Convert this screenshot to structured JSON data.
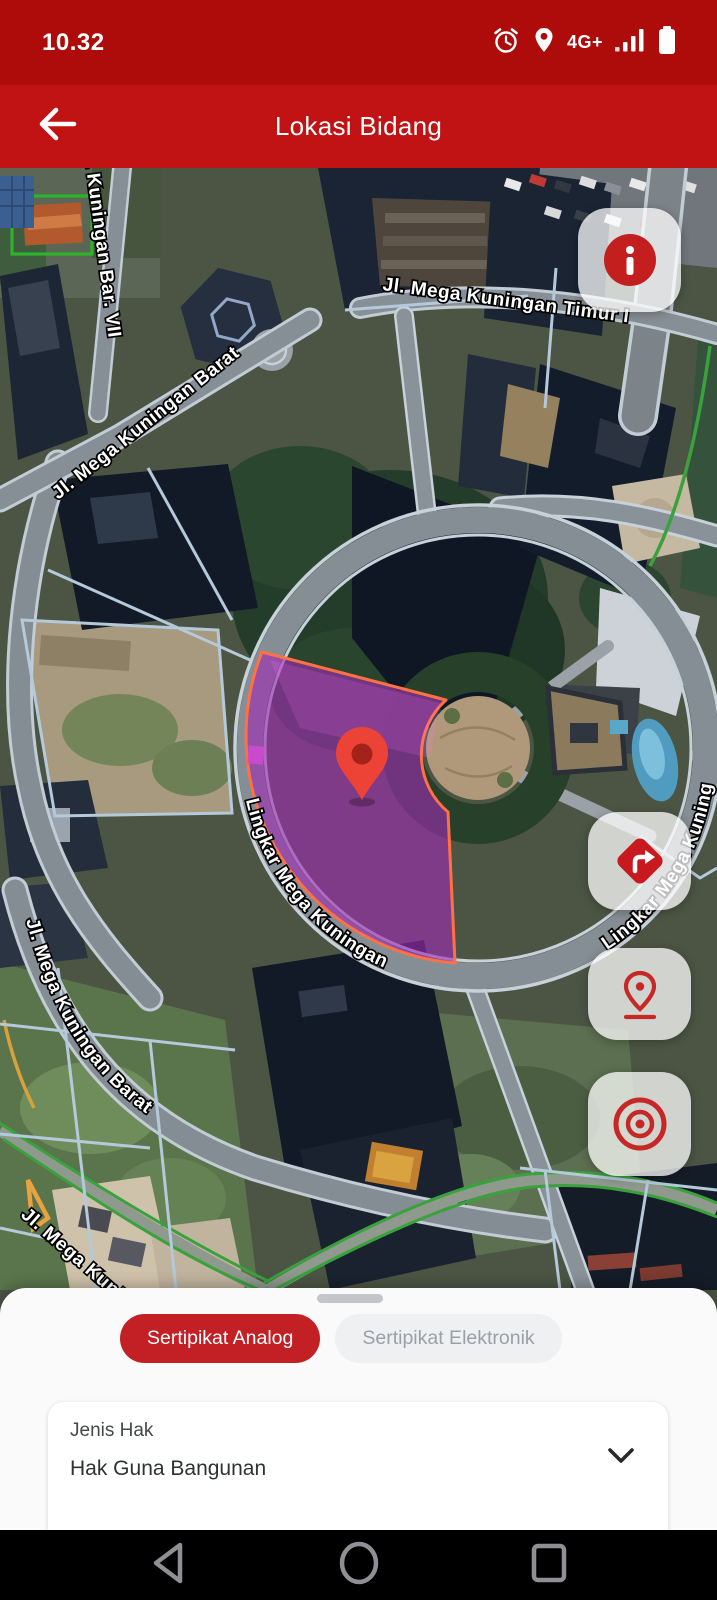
{
  "status_bar": {
    "time": "10.32",
    "network": "4G+",
    "icons": [
      "alarm-icon",
      "location-icon",
      "signal-strength-icon",
      "battery-icon"
    ],
    "bg_color": "#AE0B0B"
  },
  "header": {
    "title": "Lokasi Bidang",
    "bg_color": "#C11313",
    "icons": [
      "back-arrow-icon"
    ]
  },
  "map": {
    "labels": {
      "road_bar_vii": "Jl. Mega Kuningan Bar. VII",
      "road_barat_top": "Jl. Mega Kuningan Barat",
      "road_timur": "Jl. Mega Kuningan Timur I",
      "road_lingkar_left": "Lingkar Mega Kuningan",
      "road_lingkar_right": "Lingkar Mega Kuningan",
      "road_barat_bottom": "Jl. Mega Kuningan Barat",
      "road_bottom_corner": "Jl. Mega Kuningan"
    },
    "buttons": [
      {
        "name": "parcel-info-button",
        "icon": "info-icon"
      },
      {
        "name": "directions-button",
        "icon": "directions-icon"
      },
      {
        "name": "pin-drop-button",
        "icon": "pin-drop-icon"
      },
      {
        "name": "my-location-button",
        "icon": "target-icon"
      }
    ],
    "parcel": {
      "fill_color": "#9E2CB2",
      "stroke_color": "#FF7043"
    },
    "pin_color": "#ED4236",
    "button_icon_color": "#C41F1F"
  },
  "bottom_sheet": {
    "tabs": [
      {
        "label": "Sertipikat Analog",
        "active": true
      },
      {
        "label": "Sertipikat Elektronik",
        "active": false
      }
    ],
    "active_tab_bg": "#C32025",
    "field": {
      "label": "Jenis Hak",
      "value": "Hak Guna Bangunan",
      "icons": [
        "chevron-down-icon"
      ]
    }
  },
  "nav_bar": {
    "icons": [
      "android-back-icon",
      "android-home-icon",
      "android-recents-icon"
    ]
  }
}
